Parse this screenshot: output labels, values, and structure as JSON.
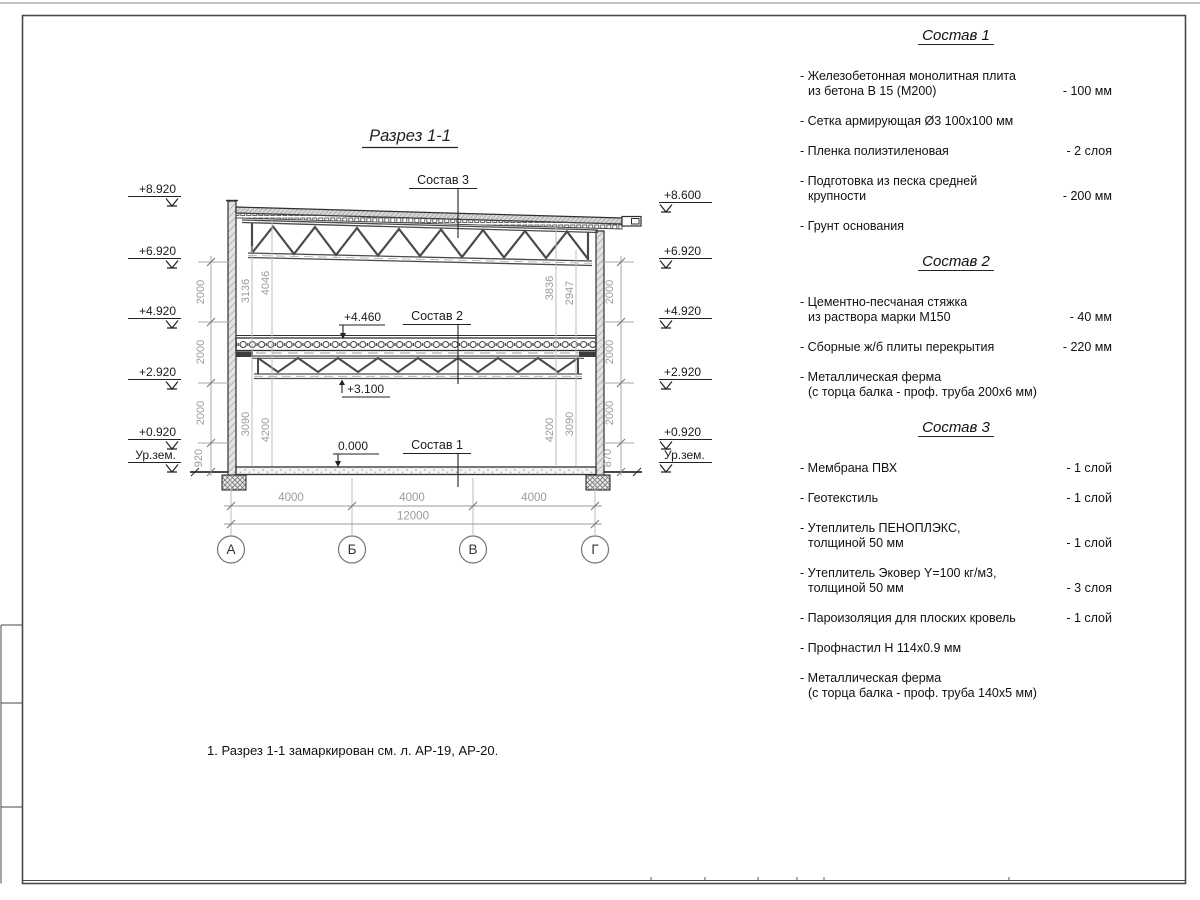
{
  "sheet": {
    "title": "Разрез 1-1",
    "note": "1. Разрез 1-1 замаркирован см. л. АР-19, АР-20."
  },
  "drawing": {
    "composition_labels": [
      "Состав 1",
      "Состав 2",
      "Состав 3"
    ],
    "level_marks": {
      "mid_floor": "+4.460",
      "truss_bottom": "+3.100",
      "floor": "0.000"
    },
    "elevations_left": [
      "+8.920",
      "+6.920",
      "+4.920",
      "+2.920",
      "+0.920",
      "Ур.зем."
    ],
    "elevations_right": [
      "+8.600",
      "+6.920",
      "+4.920",
      "+2.920",
      "+0.920",
      "Ур.зем."
    ],
    "dim_chain_left": [
      "2000",
      "2000",
      "2000",
      "920"
    ],
    "dim_chain_right": [
      "2000",
      "2000",
      "2000",
      "870"
    ],
    "dims_inner_left": {
      "top": [
        "3136",
        "4046"
      ],
      "bottom": [
        "3090",
        "4200"
      ]
    },
    "dims_inner_right": {
      "top": [
        "3836",
        "2947"
      ],
      "bottom": [
        "4200",
        "3090"
      ]
    },
    "dims_bottom": [
      "4000",
      "4000",
      "4000"
    ],
    "dim_total": "12000",
    "axes": [
      "А",
      "Б",
      "В",
      "Г"
    ]
  },
  "materials": {
    "sections": [
      {
        "title": "Состав 1",
        "items": [
          {
            "lines": [
              "- Железобетонная  монолитная плита",
              "из бетона В 15 (М200)"
            ],
            "value": "- 100 мм"
          },
          {
            "lines": [
              "- Сетка армирующая Ø3 100х100 мм"
            ],
            "value": ""
          },
          {
            "lines": [
              "- Пленка полиэтиленовая"
            ],
            "value": "-  2 слоя"
          },
          {
            "lines": [
              "- Подготовка из песка средней",
              "крупности"
            ],
            "value": "- 200 мм"
          },
          {
            "lines": [
              "- Грунт основания"
            ],
            "value": ""
          }
        ]
      },
      {
        "title": "Состав 2",
        "items": [
          {
            "lines": [
              "- Цементно-песчаная стяжка",
              "из раствора марки М150"
            ],
            "value": "- 40 мм"
          },
          {
            "lines": [
              "- Сборные ж/б плиты перекрытия"
            ],
            "value": "- 220 мм"
          },
          {
            "lines": [
              "- Металлическая ферма",
              "(с торца балка - проф. труба 200х6 мм)"
            ],
            "value": ""
          }
        ]
      },
      {
        "title": "Состав 3",
        "items": [
          {
            "lines": [
              "- Мембрана ПВХ"
            ],
            "value": "- 1 слой"
          },
          {
            "lines": [
              "- Геотекстиль"
            ],
            "value": "- 1 слой"
          },
          {
            "lines": [
              "- Утеплитель ПЕНОПЛЭКС,",
              "толщиной 50 мм"
            ],
            "value": "- 1 слой"
          },
          {
            "lines": [
              "- Утеплитель Эковер Y=100 кг/м3,",
              "толщиной 50 мм"
            ],
            "value": "- 3 слоя"
          },
          {
            "lines": [
              "- Пароизоляция для плоских кровель"
            ],
            "value": "- 1 слой"
          },
          {
            "lines": [
              "- Профнастил Н 114х0.9 мм"
            ],
            "value": ""
          },
          {
            "lines": [
              "- Металлическая ферма",
              "(с торца балка - проф. труба 140х5 мм)"
            ],
            "value": ""
          }
        ]
      }
    ]
  }
}
